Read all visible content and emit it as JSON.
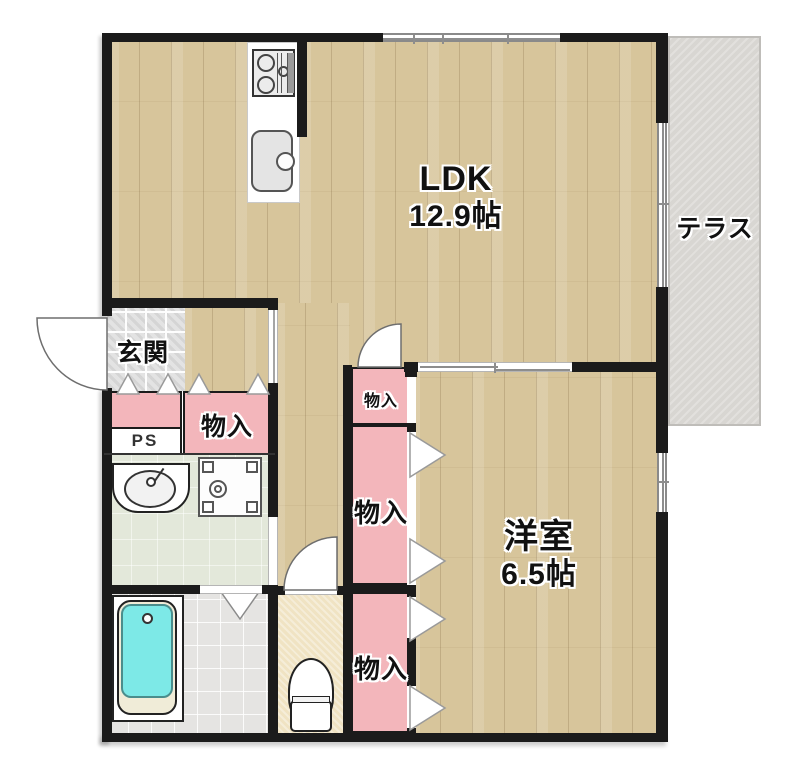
{
  "rooms": {
    "ldk": {
      "name": "LDK",
      "size": "12.9帖"
    },
    "terrace": {
      "name": "テラス"
    },
    "genkan": {
      "name": "玄関"
    },
    "yoshitsu": {
      "name": "洋室",
      "size": "6.5帖"
    },
    "ps": {
      "label": "PS"
    },
    "closet_hall": {
      "label": "物入"
    },
    "closet_small": {
      "label": "物入"
    },
    "closet_middle": {
      "label": "物入"
    },
    "closet_lower": {
      "label": "物入"
    }
  },
  "colors": {
    "wall": "#1b1b1b",
    "closet_pink": "#f3b6bb",
    "wood_floor": "#d7c59b",
    "terrace_gray": "#d8d6d2",
    "bathtub_cyan": "#7de9e7",
    "washroom_green": "#e3e8da",
    "toilet_cream": "#f0e3c3",
    "genkan_tile": "#e3e3e3"
  }
}
